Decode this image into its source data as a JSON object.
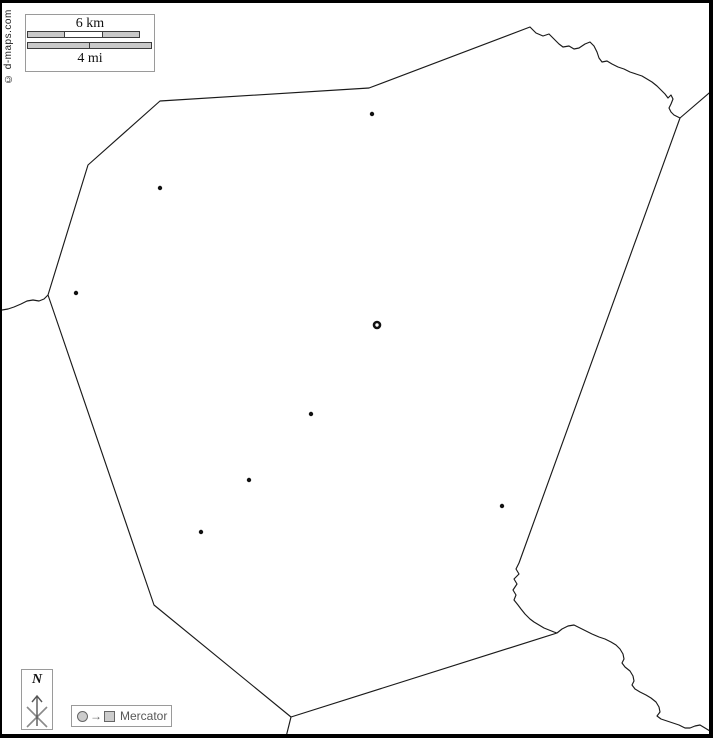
{
  "watermark": {
    "text": "© d-maps.com"
  },
  "scale_box": {
    "km_label": "6 km",
    "mi_label": "4 mi",
    "km_segment_colors": [
      "#c9c9c9",
      "#ffffff",
      "#c9c9c9"
    ],
    "mi_segment_colors": [
      "#c9c9c9",
      "#c9c9c9"
    ]
  },
  "compass": {
    "north_label": "N"
  },
  "projection_legend": {
    "label": "Mercator"
  },
  "colors": {
    "border_line": "#1a1a1a",
    "city_dot": "#111111",
    "frame": "#000000",
    "box_border": "#9a9a9a",
    "legend_gray": "#666666",
    "legend_fill": "#cccccc"
  },
  "map": {
    "region_outline": "M158,98 L367,85 L528,24 L534,30 L541,33 L547,31 L552,36 L557,41 L561,44 L567,43 L572,46 L577,45 L583,41 L588,39 L592,43 L595,49 L597,55 L600,59 L605,58 L610,61 L616,64 L622,66 L628,69 L634,71 L640,73 L645,76 L650,79 L655,83 L659,87 L663,91 L666,95 L669,92 L671,96 L669,101 L667,105 L669,109 L672,112 L678,115 L517,560 L514,566 L517,571 L512,576 L515,581 L511,587 L514,592 L512,597 L516,602 L519,606 L523,611 L528,616 L532,619 L537,622 L542,625 L547,627 L552,629 L555,630 L289,714 L152,602 L46,292 L86,162 Z",
    "neighbor_borders": [
      {
        "name": "border-west-wavy",
        "d": "M46,292 L42,296 L37,298 L31,297 L25,298 L19,301 L12,304 L6,306 L0,307"
      },
      {
        "name": "border-northeast",
        "d": "M678,115 L713,85"
      },
      {
        "name": "border-southeast-river",
        "d": "M555,630 L560,626 L566,623 L572,622 L578,625 L584,628 L590,631 L597,634 L603,636 L609,639 L614,642 L618,646 L621,651 L622,656 L620,660 L623,664 L628,668 L631,673 L632,678 L630,682 L633,686 L638,689 L644,692 L649,695 L654,699 L657,704 L658,709 L655,713 L659,716 L665,718 L671,720 L677,722 L683,725 L688,725 L693,723 L698,722 L703,725 L708,728 L713,731"
      },
      {
        "name": "border-south",
        "d": "M289,714 L283,738"
      }
    ],
    "cities": [
      {
        "x": 370,
        "y": 111
      },
      {
        "x": 158,
        "y": 185
      },
      {
        "x": 74,
        "y": 290
      },
      {
        "x": 309,
        "y": 411
      },
      {
        "x": 247,
        "y": 477
      },
      {
        "x": 199,
        "y": 529
      },
      {
        "x": 500,
        "y": 503
      }
    ],
    "capital": {
      "x": 375,
      "y": 322
    }
  }
}
